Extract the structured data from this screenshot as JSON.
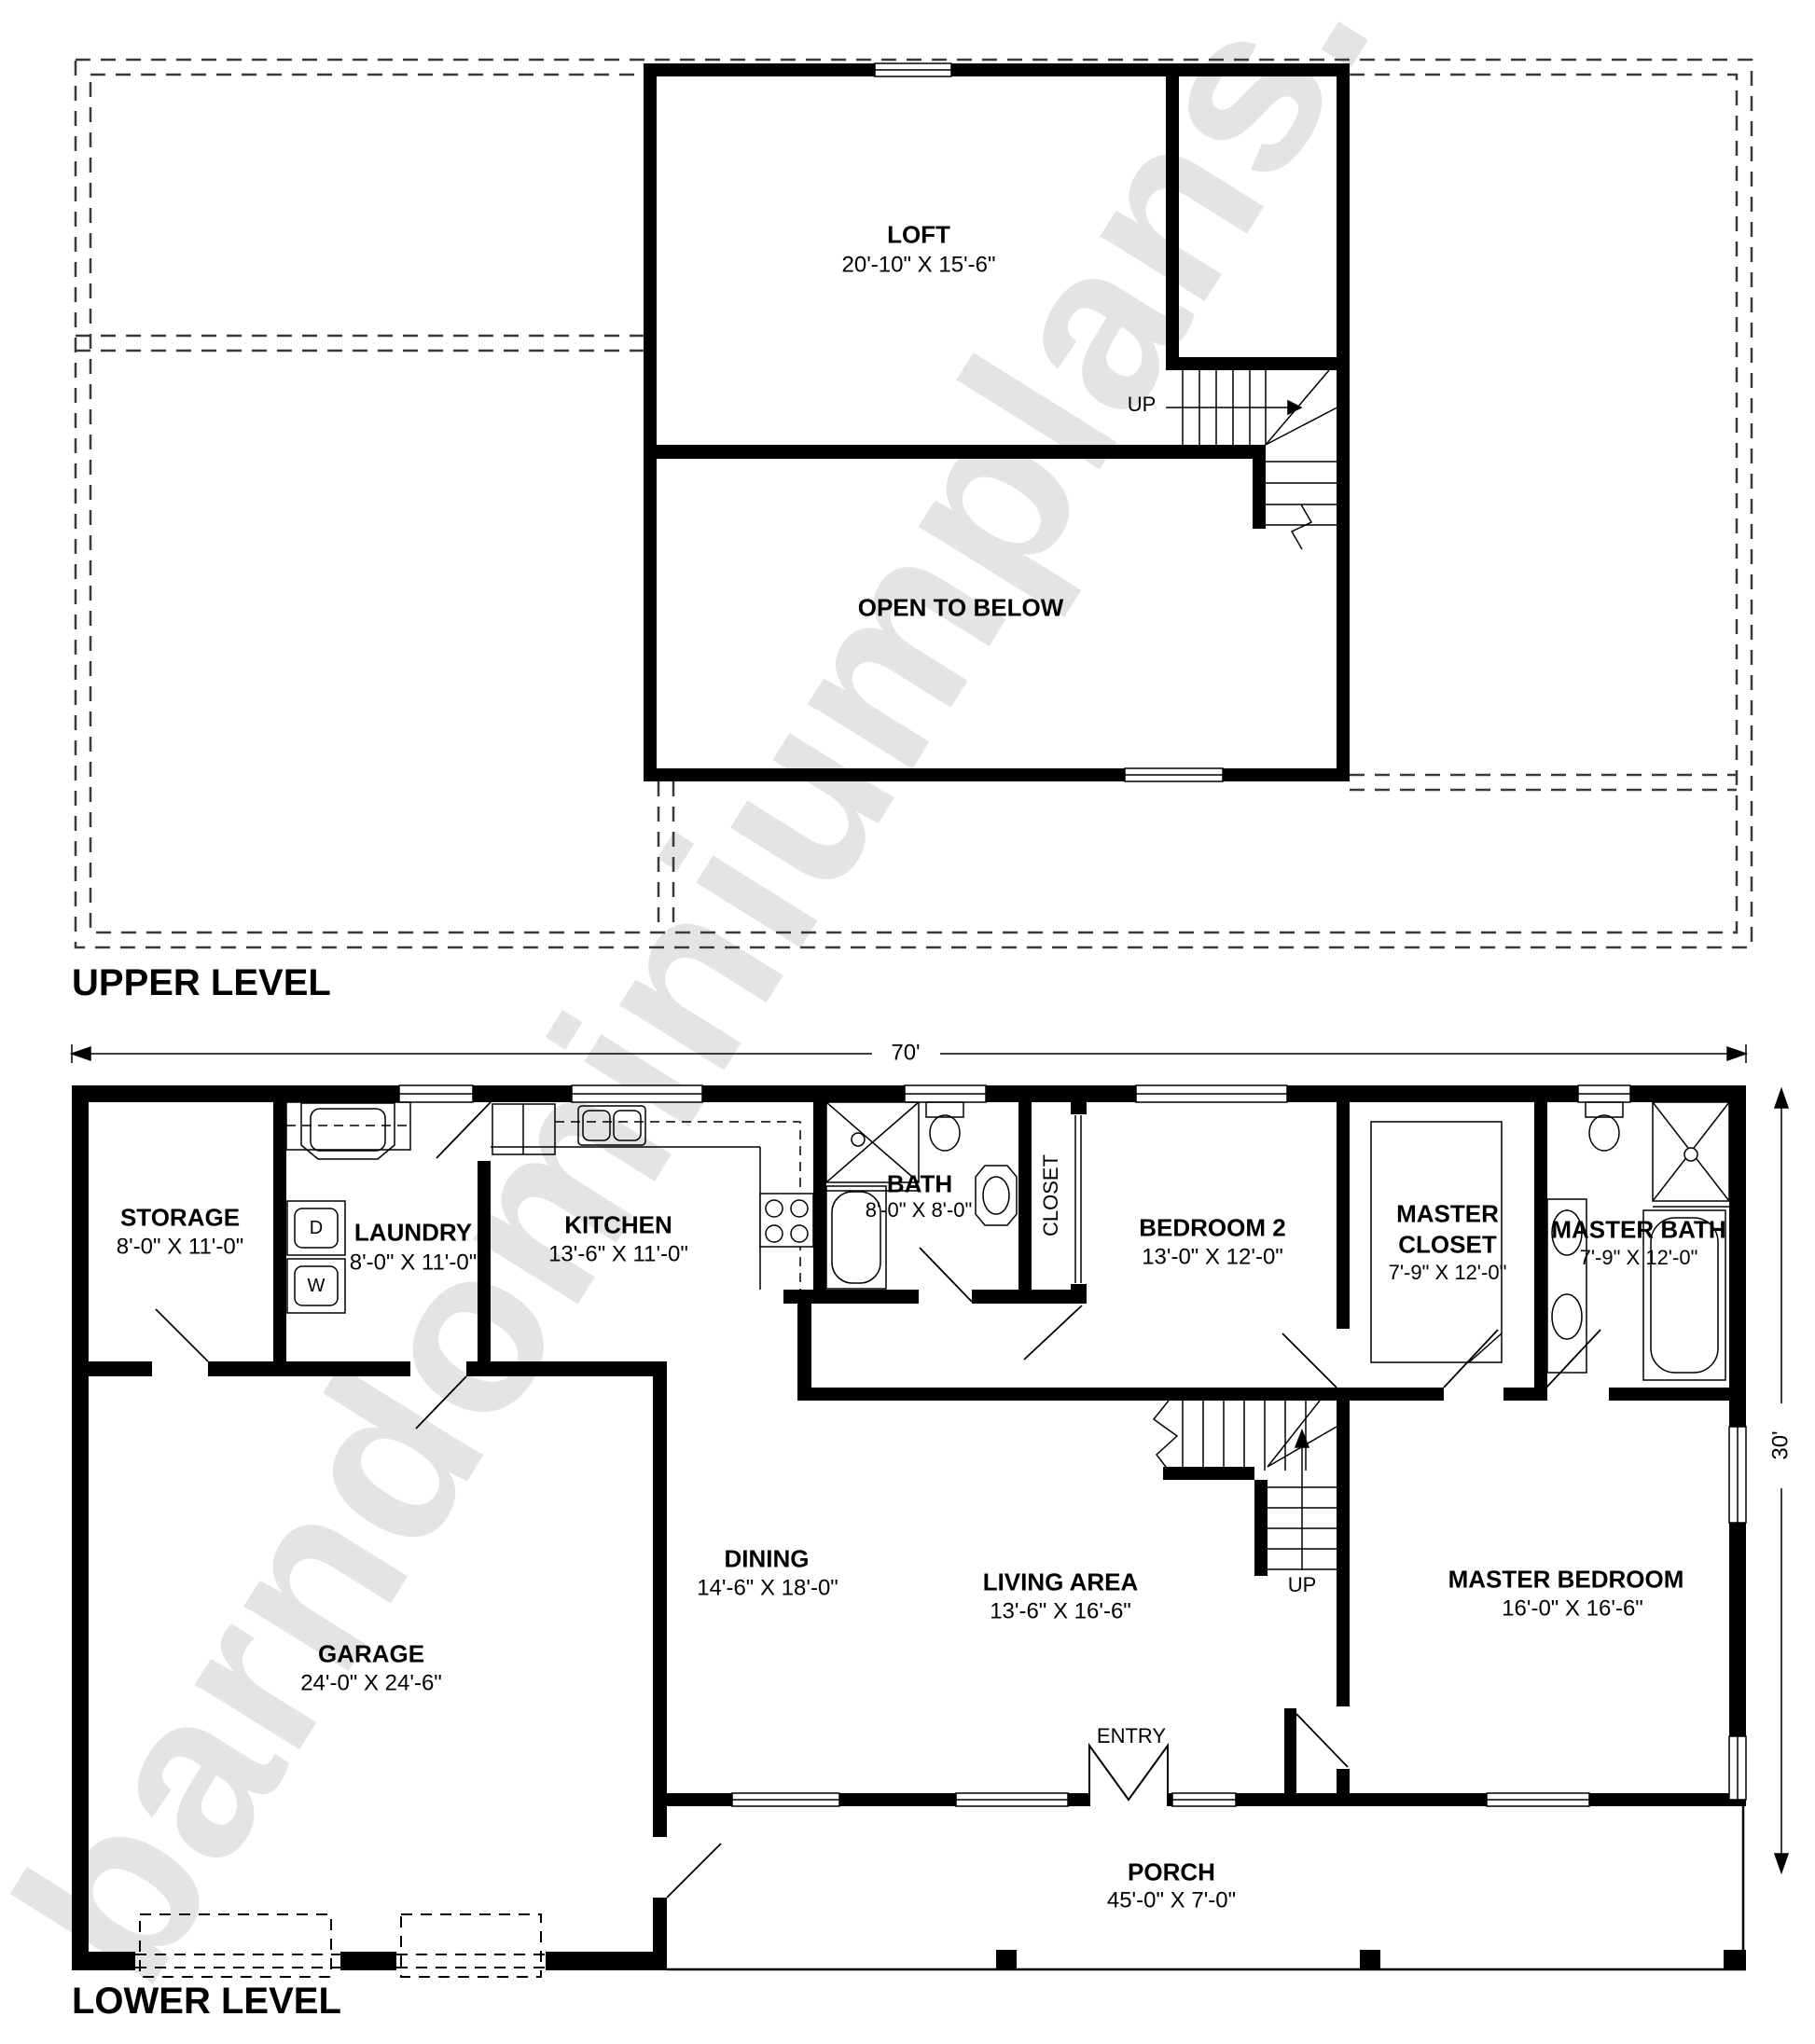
{
  "watermark": "barndominiumplans.com",
  "upper_level": {
    "title": "UPPER LEVEL",
    "rooms": {
      "loft": {
        "name": "LOFT",
        "dims": "20'-10\" X 15'-6\""
      },
      "open_to_below": {
        "name": "OPEN TO BELOW"
      }
    },
    "stairs": {
      "up": "UP"
    }
  },
  "lower_level": {
    "title": "LOWER LEVEL",
    "overall_width": "70'",
    "overall_depth": "30'",
    "rooms": {
      "storage": {
        "name": "STORAGE",
        "dims": "8'-0\" X 11'-0\""
      },
      "laundry": {
        "name": "LAUNDRY",
        "dims": "8'-0\" X 11'-0\""
      },
      "kitchen": {
        "name": "KITCHEN",
        "dims": "13'-6\" X 11'-0\""
      },
      "bath": {
        "name": "BATH",
        "dims": "8'-0\" X 8'-0\""
      },
      "closet": {
        "name": "CLOSET"
      },
      "bedroom2": {
        "name": "BEDROOM 2",
        "dims": "13'-0\" X 12'-0\""
      },
      "master_closet": {
        "name": "MASTER CLOSET",
        "dims": "7'-9\" X 12'-0\""
      },
      "master_bath": {
        "name": "MASTER BATH",
        "dims": "7'-9\" X 12'-0\""
      },
      "garage": {
        "name": "GARAGE",
        "dims": "24'-0\" X 24'-6\""
      },
      "dining": {
        "name": "DINING",
        "dims": "14'-6\" X 18'-0\""
      },
      "living_area": {
        "name": "LIVING AREA",
        "dims": "13'-6\" X 16'-6\""
      },
      "master_bedroom": {
        "name": "MASTER BEDROOM",
        "dims": "16'-0\" X 16'-6\""
      },
      "porch": {
        "name": "PORCH",
        "dims": "45'-0\" X 7'-0\""
      }
    },
    "labels": {
      "up": "UP",
      "entry": "ENTRY"
    },
    "appliances": {
      "dryer": "D",
      "washer": "W"
    }
  }
}
